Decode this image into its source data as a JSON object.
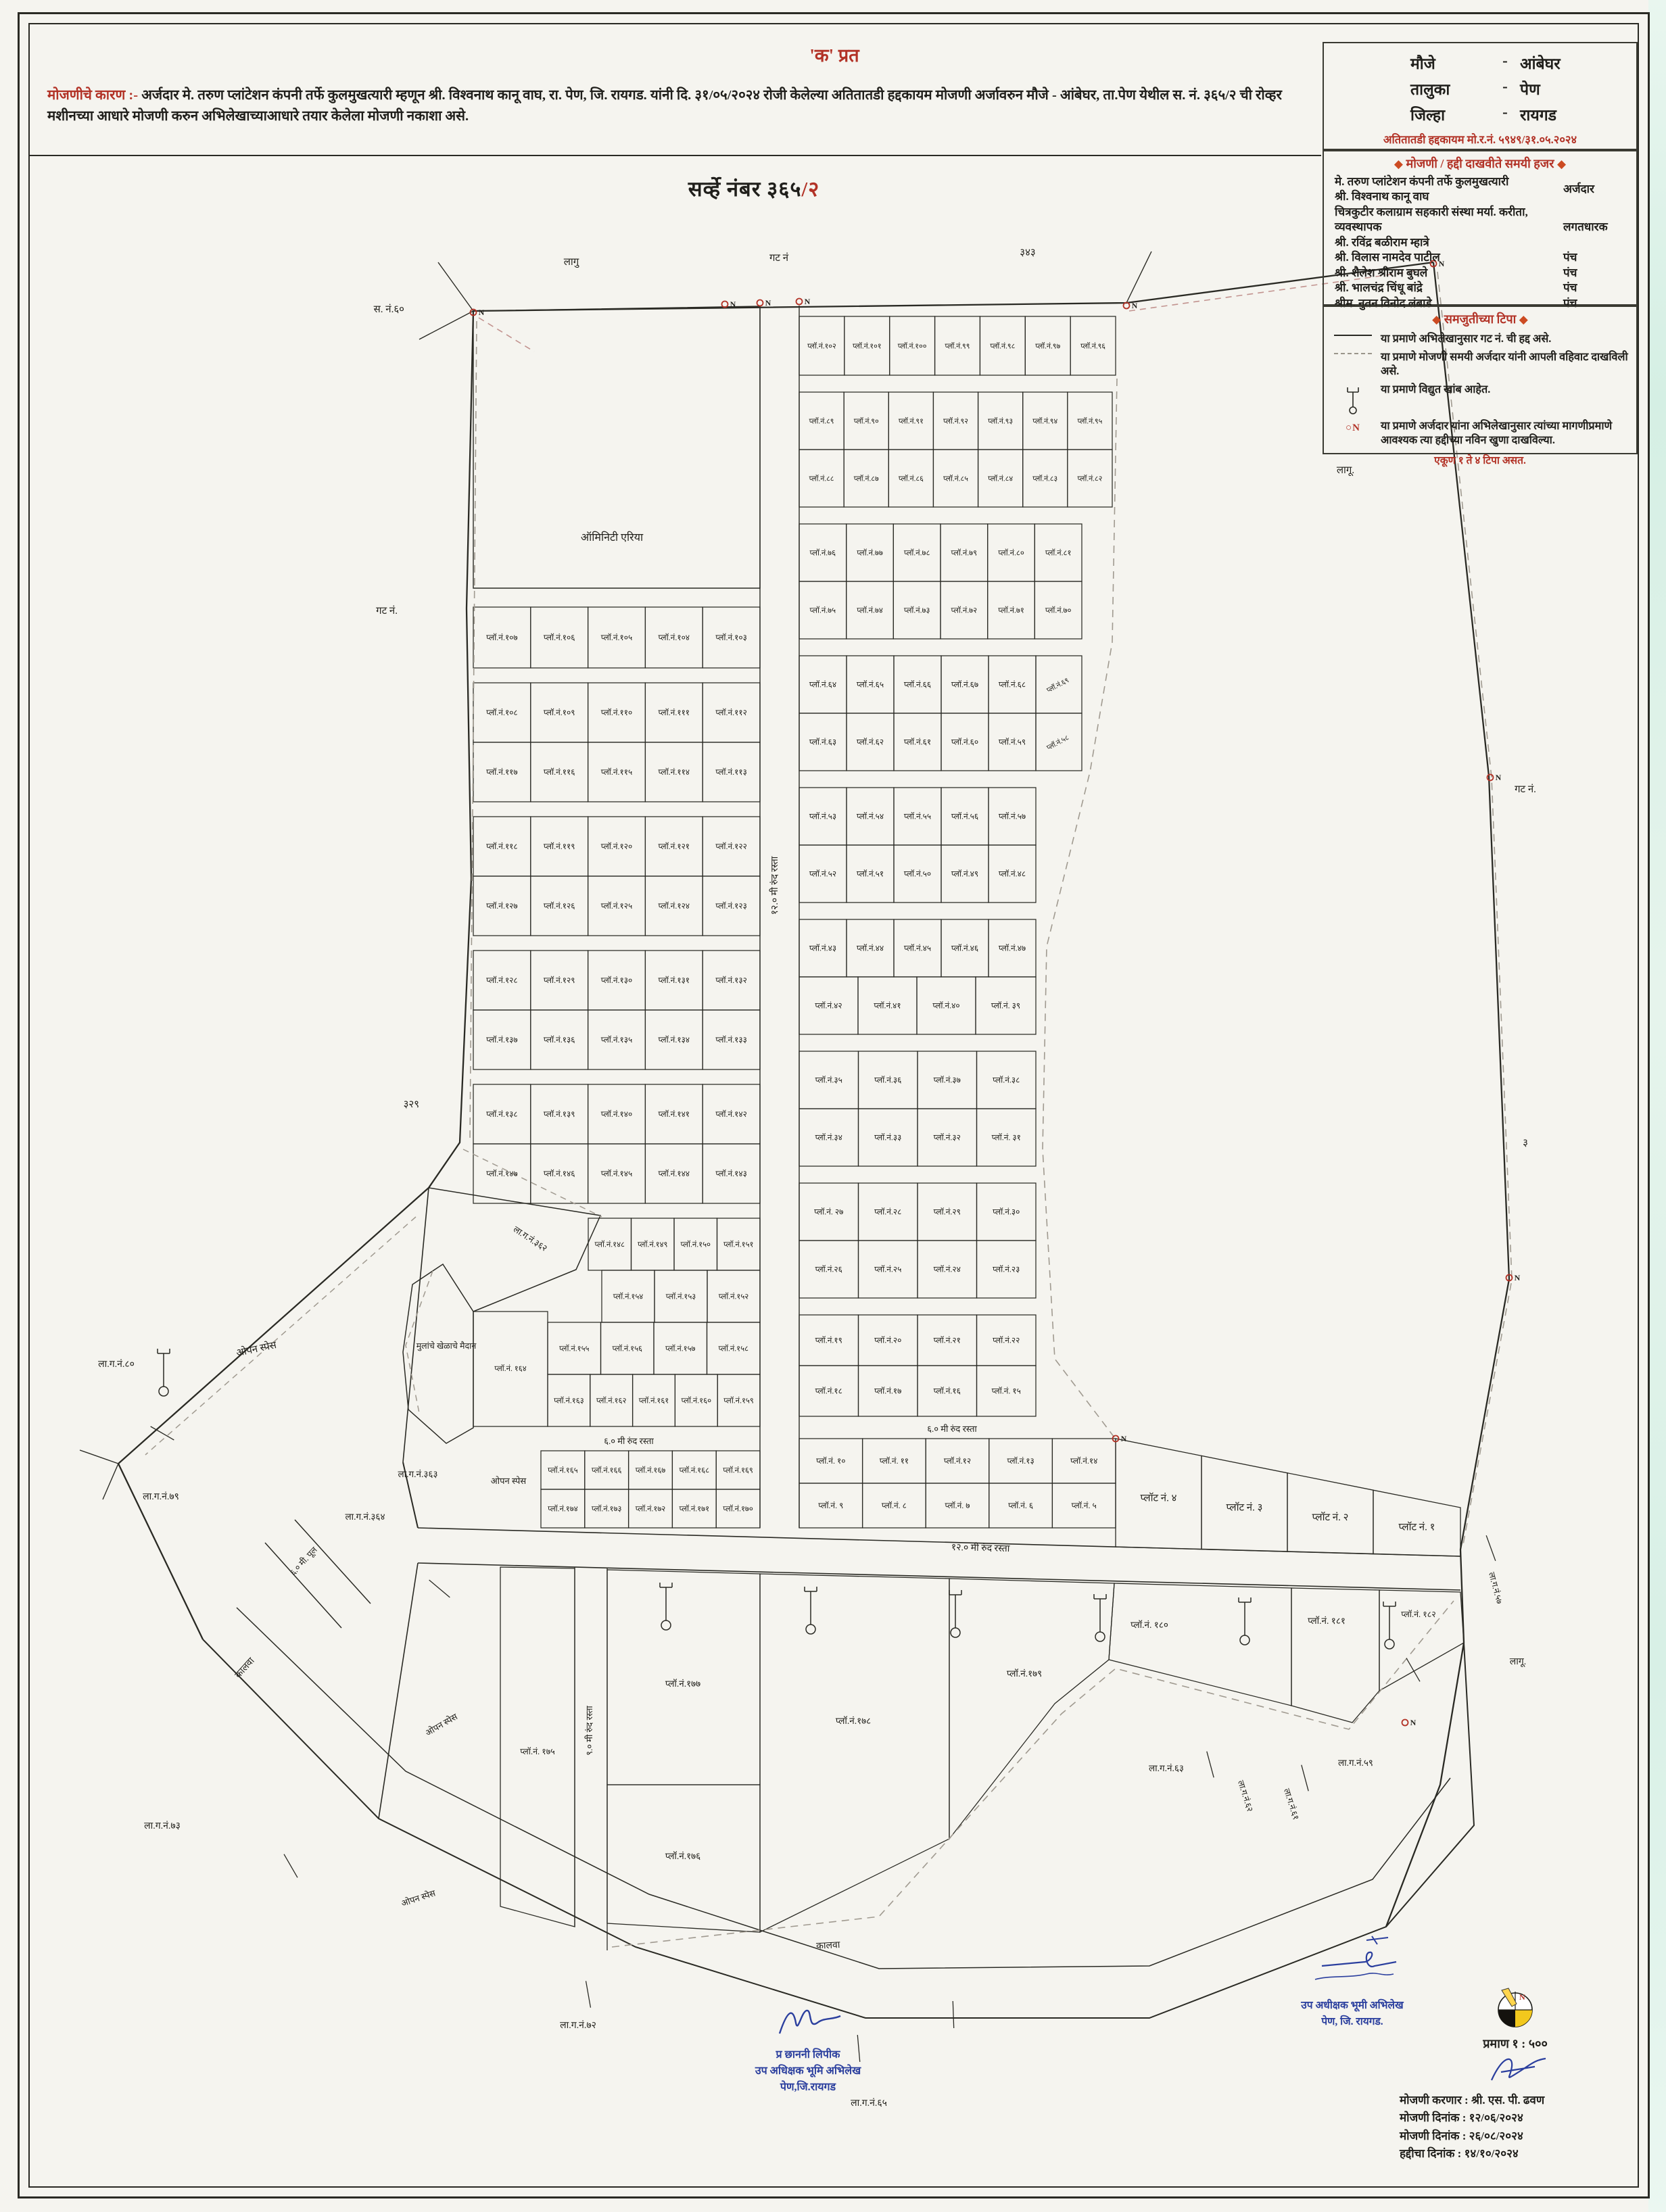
{
  "doc": {
    "copy_title": "'क' प्रत",
    "reason_label": "मोजणीचे कारण :-",
    "reason_text": "अर्जदार मे. तरुण प्लांटेशन कंपनी तर्फे कुलमुखत्यारी म्हणून श्री. विश्वनाथ कानू वाघ, रा. पेण, जि. रायगड. यांनी दि. ३१/०५/२०२४ रोजी केलेल्या अतितातडी हद्दकायम मोजणी अर्जावरुन मौजे - आंबेघर, ता.पेण येथील स. नं. ३६५/२ ची रोव्हर मशीनच्या आधारे मोजणी करुन अभिलेखाच्याआधारे तयार केलेला मोजणी नकाशा असे."
  },
  "info_box": {
    "rows": [
      {
        "label": "मौजे",
        "dash": "-",
        "value": "आंबेघर"
      },
      {
        "label": "तालुका",
        "dash": "-",
        "value": "पेण"
      },
      {
        "label": "जिल्हा",
        "dash": "-",
        "value": "रायगड"
      }
    ],
    "case_line": "अतितातडी हद्दकायम मो.र.नं. ५९४९/३१.०५.२०२४"
  },
  "present_box": {
    "title": "मोजणी / हद्दी दाखवीते समयी हजर",
    "rows": [
      {
        "name_lines": [
          "मे. तरुण प्लांटेशन कंपनी तर्फे कुलमुखत्यारी",
          "श्री. विश्वनाथ कानू वाघ"
        ],
        "role": "अर्जदार"
      },
      {
        "name_lines": [
          "चित्रकुटीर कलाग्राम सहकारी संस्था मर्या. करीता, व्यवस्थापक",
          "श्री. रविंद्र बळीराम म्हात्रे"
        ],
        "role": "लगतधारक"
      },
      {
        "name_lines": [
          "श्री. विलास नामदेव पाटील"
        ],
        "role": "पंच"
      },
      {
        "name_lines": [
          "श्री. शैलेश श्रीराम बुघले"
        ],
        "role": "पंच"
      },
      {
        "name_lines": [
          "श्री. भालचंद्र चिंधू बांद्रे"
        ],
        "role": "पंच"
      },
      {
        "name_lines": [
          "श्रीम. नुतन विनोद लंबाडे"
        ],
        "role": "पंच"
      }
    ]
  },
  "notes_box": {
    "title": "समजुतीच्या टिपा",
    "items": [
      {
        "symbol": "solid-line",
        "text": "या प्रमाणे अभिलेखानुसार गट नं. ची हद्द असे."
      },
      {
        "symbol": "dashed-line",
        "text": "या प्रमाणे मोजणी समयी अर्जदार यांनी आपली वहिवाट दाखविली असे."
      },
      {
        "symbol": "electric-pole",
        "text": "या प्रमाणे विद्युत खांब आहेत."
      },
      {
        "symbol": "on-marker",
        "text": "या प्रमाणे अर्जदार यांना अभिलेखानुसार त्यांच्या मागणीप्रमाणे आवश्यक त्या हद्दीच्या नविन खुणा दाखविल्या."
      }
    ],
    "footer": "एकूण १ ते ४ टिपा असत."
  },
  "signatures": {
    "clerk": {
      "line1": "प्र छाननी लिपीक",
      "line2": "उप अधिक्षक भूमि अभिलेख",
      "line3": "पेण,जि.रायगड"
    },
    "officer": {
      "line1": "उप अधीक्षक भूमी अभिलेख",
      "line2": "पेण, जि. रायगड."
    }
  },
  "scale_block": {
    "scale": "प्रमाण १ : ५००",
    "surveyor": "मोजणी करणार : श्री. एस. पी. ढवण",
    "date1": "मोजणी दिनांक : १२/०६/२०२४",
    "date2": "मोजणी दिनांक : २६/०८/२०२४",
    "date3": "हद्दीचा दिनांक : १४/१०/२०२४"
  },
  "colors": {
    "accent_red": "#b23226",
    "ink_blue": "#2b3f9e",
    "line": "#2a2a24",
    "dash_grey": "#a09a90"
  },
  "map": {
    "title_main": "सर्व्हे नंबर ३६५",
    "title_suffix": "/२",
    "amenity_label": "ऑमिनिटी एरिया",
    "playground_label": "मुलांचे खेळाचे मैदान",
    "road_center": "१२.० मी रुंद रस्ता",
    "road_bottom": "१२.० मी रुंद रस्ता",
    "road_6m_west": "६.० मी रुंद रस्ता",
    "road_6m_east": "६.० मी रुंद रस्ता",
    "road_south_vertical": "९.० मी रुंद रस्ता",
    "bridge_label": "६.० मी. पूल",
    "canal_label_1": "कालवा",
    "canal_label_2": "कालवा",
    "open_space_1": "ओपन स्पेस",
    "open_space_2": "ओपन स्पेस",
    "open_space_3": "ओपन स्पेस",
    "open_space_4": "ओपन स्पेस",
    "marker_n": "N",
    "rows": {
      "w107": [
        "प्लॉ.नं.१०७",
        "प्लॉ.नं.१०६",
        "प्लॉ.नं.१०५",
        "प्लॉ.नं.१०४",
        "प्लॉ.नं.१०३"
      ],
      "w108": [
        "प्लॉ.नं.१०८",
        "प्लॉ.नं.१०९",
        "प्लॉ.नं.११०",
        "प्लॉ.नं.१११",
        "प्लॉ.नं.११२"
      ],
      "w117": [
        "प्लॉ.नं.११७",
        "प्लॉ.नं.११६",
        "प्लॉ.नं.११५",
        "प्लॉ.नं.११४",
        "प्लॉ.नं.११३"
      ],
      "w118": [
        "प्लॉ.नं.११८",
        "प्लॉ.नं.११९",
        "प्लॉ.नं.१२०",
        "प्लॉ.नं.१२१",
        "प्लॉ.नं.१२२"
      ],
      "w127": [
        "प्लॉ.नं.१२७",
        "प्लॉ.नं.१२६",
        "प्लॉ.नं.१२५",
        "प्लॉ.नं.१२४",
        "प्लॉ.नं.१२३"
      ],
      "w128": [
        "प्लॉ.नं.१२८",
        "प्लॉ.नं.१२९",
        "प्लॉ.नं.१३०",
        "प्लॉ.नं.१३१",
        "प्लॉ.नं.१३२"
      ],
      "w137": [
        "प्लॉ.नं.१३७",
        "प्लॉ.नं.१३६",
        "प्लॉ.नं.१३५",
        "प्लॉ.नं.१३४",
        "प्लॉ.नं.१३३"
      ],
      "w138": [
        "प्लॉ.नं.१३८",
        "प्लॉ.नं.१३९",
        "प्लॉ.नं.१४०",
        "प्लॉ.नं.१४१",
        "प्लॉ.नं.१४२"
      ],
      "w147": [
        "प्लॉ.नं.१४७",
        "प्लॉ.नं.१४६",
        "प्लॉ.नं.१४५",
        "प्लॉ.नं.१४४",
        "प्लॉ.नं.१४३"
      ],
      "w148": [
        "प्लॉ.नं.१४८",
        "प्लॉ.नं.१४९",
        "प्लॉ.नं.१५०",
        "प्लॉ.नं.१५१"
      ],
      "w154": [
        "प्लॉ.नं.१५४",
        "प्लॉ.नं.१५३",
        "प्लॉ.नं.१५२"
      ],
      "w155": [
        "प्लॉ.नं.१५५",
        "प्लॉ.नं.१५६",
        "प्लॉ.नं.१५७",
        "प्लॉ.नं.१५८"
      ],
      "w163": [
        "प्लॉ.नं.१६३",
        "प्लॉ.नं.१६२",
        "प्लॉ.नं.१६१",
        "प्लॉ.नं.१६०",
        "प्लॉ.नं.१५९"
      ],
      "w165": [
        "प्लॉ.नं.१६५",
        "प्लॉ.नं.१६६",
        "प्लॉ.नं.१६७",
        "प्लॉ.नं.१६८",
        "प्लॉ.नं.१६९"
      ],
      "w174": [
        "प्लॉ.नं.१७४",
        "प्लॉ.नं.१७३",
        "प्लॉ.नं.१७२",
        "प्लॉ.नं.१७१",
        "प्लॉ.नं.१७०"
      ],
      "e102": [
        "प्लॉ.नं.१०२",
        "प्लॉ.नं.१०१",
        "प्लॉ.नं.१००",
        "प्लॉ.नं.९९",
        "प्लॉ.नं.९८",
        "प्लॉ.नं.९७",
        "प्लॉ.नं.९६"
      ],
      "e89": [
        "प्लॉ.नं.८९",
        "प्लॉ.नं.९०",
        "प्लॉ.नं.९१",
        "प्लॉ.नं.९२",
        "प्लॉ.नं.९३",
        "प्लॉ.नं.९४",
        "प्लॉ.नं.९५"
      ],
      "e88": [
        "प्लॉ.नं.८८",
        "प्लॉ.नं.८७",
        "प्लॉ.नं.८६",
        "प्लॉ.नं.८५",
        "प्लॉ.नं.८४",
        "प्लॉ.नं.८३",
        "प्लॉ.नं.८२"
      ],
      "e76": [
        "प्लॉ.नं.७६",
        "प्लॉ.नं.७७",
        "प्लॉ.नं.७८",
        "प्लॉ.नं.७९",
        "प्लॉ.नं.८०",
        "प्लॉ.नं.८१"
      ],
      "e75": [
        "प्लॉ.नं.७५",
        "प्लॉ.नं.७४",
        "प्लॉ.नं.७३",
        "प्लॉ.नं.७२",
        "प्लॉ.नं.७१",
        "प्लॉ.नं.७०"
      ],
      "e64": [
        "प्लॉ.नं.६४",
        "प्लॉ.नं.६५",
        "प्लॉ.नं.६६",
        "प्लॉ.नं.६७",
        "प्लॉ.नं.६८"
      ],
      "e63": [
        "प्लॉ.नं.६३",
        "प्लॉ.नं.६२",
        "प्लॉ.नं.६१",
        "प्लॉ.नं.६०",
        "प्लॉ.नं.५९"
      ],
      "e53": [
        "प्लॉ.नं.५३",
        "प्लॉ.नं.५४",
        "प्लॉ.नं.५५",
        "प्लॉ.नं.५६",
        "प्लॉ.नं.५७"
      ],
      "e52": [
        "प्लॉ.नं.५२",
        "प्लॉ.नं.५१",
        "प्लॉ.नं.५०",
        "प्लॉ.नं.४९",
        "प्लॉ.नं.४८"
      ],
      "e43": [
        "प्लॉ.नं.४३",
        "प्लॉ.नं.४४",
        "प्लॉ.नं.४५",
        "प्लॉ.नं.४६",
        "प्लॉ.नं.४७"
      ],
      "e42": [
        "प्लॉ.नं.४२",
        "प्लॉ.नं.४१",
        "प्लॉ.नं.४०",
        "प्लॉ.नं. ३९"
      ],
      "e35": [
        "प्लॉ.नं.३५",
        "प्लॉ.नं.३६",
        "प्लॉ.नं.३७",
        "प्लॉ.नं.३८"
      ],
      "e34": [
        "प्लॉ.नं.३४",
        "प्लॉ.नं.३३",
        "प्लॉ.नं.३२",
        "प्लॉ.नं. ३१"
      ],
      "e27": [
        "प्लॉ.नं. २७",
        "प्लॉ.नं.२८",
        "प्लॉ.नं.२९",
        "प्लॉ.नं.३०"
      ],
      "e26": [
        "प्लॉ.नं.२६",
        "प्लॉ.नं.२५",
        "प्लॉ.नं.२४",
        "प्लॉ.नं.२३"
      ],
      "e19": [
        "प्लॉ.नं.१९",
        "प्लॉ.नं.२०",
        "प्लॉ.नं.२१",
        "प्लॉ.नं.२२"
      ],
      "e18": [
        "प्लॉ.नं.१८",
        "प्लॉ.नं.१७",
        "प्लॉ.नं.१६",
        "प्लॉ.नं. १५"
      ],
      "e10": [
        "प्लॉ.नं. १०",
        "प्लॉ.नं. ११",
        "प्लॉ.नं.१२",
        "प्लॉ.नं.१३",
        "प्लॉ.नं.१४"
      ],
      "e9": [
        "प्लॉ.नं. ९",
        "प्लॉ.नं. ८",
        "प्लॉ.नं. ७",
        "प्लॉ.नं. ६",
        "प्लॉ.नं. ५"
      ]
    },
    "e69": "प्लॉ.नं.६९",
    "e58": "प्लॉ.नं.५८",
    "p164": "प्लॉ.नं. १६४",
    "south_plots": [
      "प्लॉ.नं. १७५",
      "प्लॉ.नं.१७७",
      "प्लॉ.नं.१७६",
      "प्लॉ.नं.१७८",
      "प्लॉ.नं.१७९",
      "प्लॉ.नं. १८०",
      "प्लॉ.नं. १८१",
      "प्लॉ.नं. १८२"
    ],
    "big_plots": [
      "प्लॉट नं. ४",
      "प्लॉट नं. ३",
      "प्लॉट नं. २",
      "प्लॉट नं. १"
    ],
    "outside_labels": {
      "sn60": "स. नं.६०",
      "lagu_top": "लागु",
      "gat_top": "गट नं",
      "g343": "३४३",
      "lagu_right": "लागू.",
      "gat_right": "गट नं.",
      "g3": "३",
      "gat_left": "गट नं.",
      "g329": "३२९",
      "lagu_se": "लागू.",
      "lg80": "ला.ग.नं.८०",
      "lg79": "ला.ग.नं.७९",
      "lg73": "ला.ग.नं.७३",
      "lg72": "ला.ग.नं.७२",
      "lg65": "ला.ग.नं.६५",
      "lg362": "ला.ग.नं.३६२",
      "lg363": "ला.ग.नं.३६३",
      "lg364": "ला.ग.नं.३६४",
      "lg63": "ला.ग.नं.६३",
      "lg62": "ला.ग.नं.६२",
      "lg61": "ला.ग.नं.६१",
      "lg59": "ला.ग.नं.५९",
      "lg57": "ला.ग.नं.५७"
    }
  }
}
